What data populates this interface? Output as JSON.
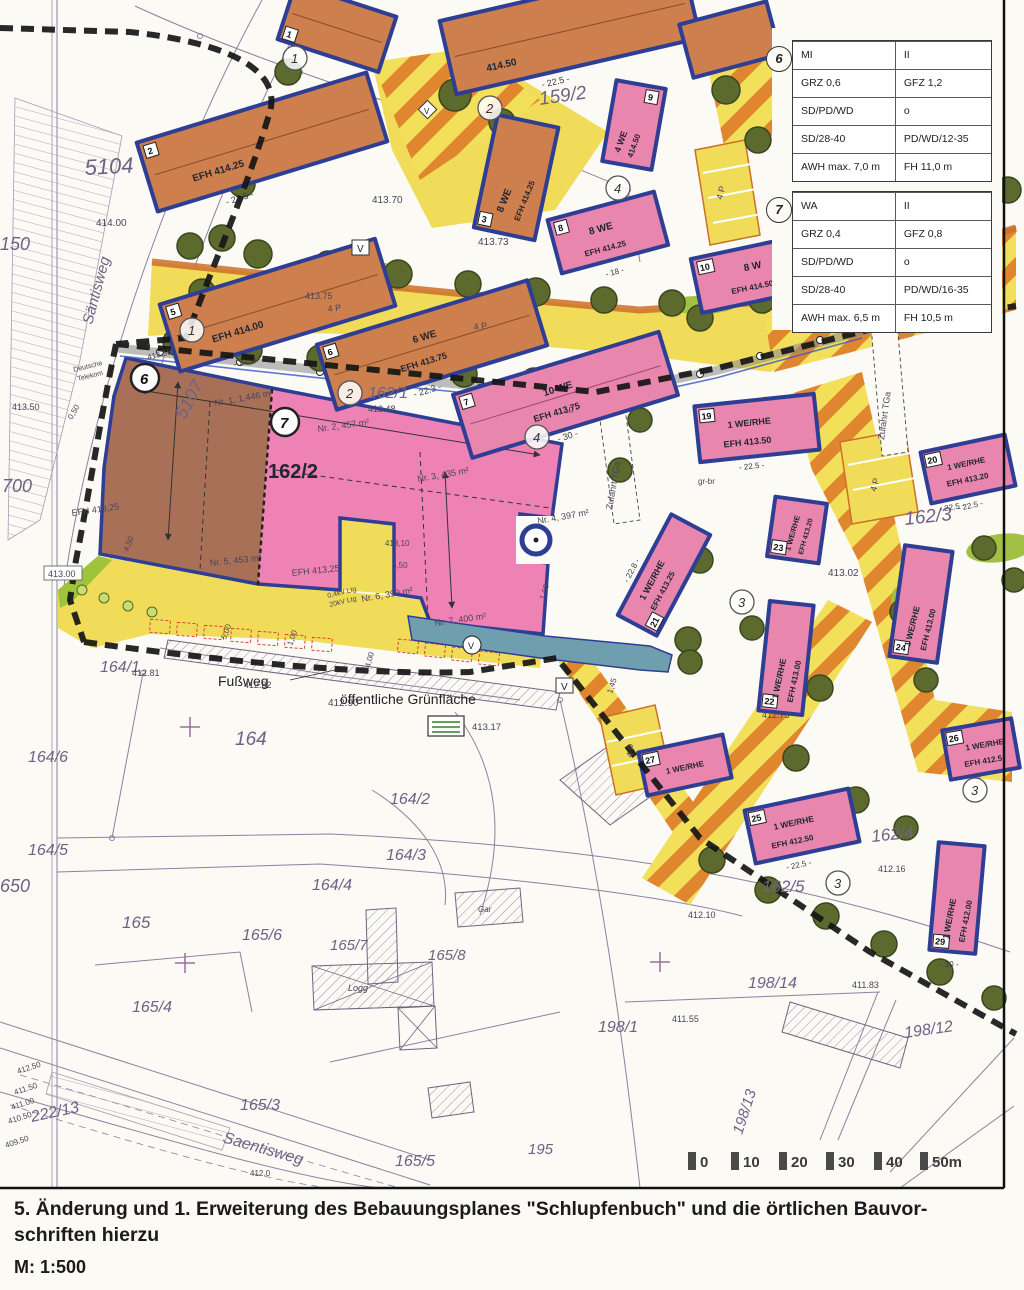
{
  "page": {
    "caption_line1": "5. Änderung und 1. Erweiterung des Bebauungsplanes \"Schlupfenbuch\" und die örtlichen Bauvor-",
    "caption_line2": "schriften hierzu",
    "scale_label": "M: 1:500"
  },
  "legend": {
    "zones": [
      {
        "marker": "6",
        "rows": [
          [
            "MI",
            "II"
          ],
          [
            "GRZ 0,6",
            "GFZ 1,2"
          ],
          [
            "SD/PD/WD",
            "o"
          ],
          [
            "SD/28-40",
            "PD/WD/12-35"
          ],
          [
            "AWH max. 7,0 m",
            "FH 11,0 m"
          ]
        ]
      },
      {
        "marker": "7",
        "rows": [
          [
            "WA",
            "II"
          ],
          [
            "GRZ 0,4",
            "GFZ 0,8"
          ],
          [
            "SD/PD/WD",
            "o"
          ],
          [
            "SD/28-40",
            "PD/WD/16-35"
          ],
          [
            "AWH max. 6,5 m",
            "FH 10,5 m"
          ]
        ]
      }
    ]
  },
  "scalebar": {
    "ticks": [
      "0",
      "10",
      "20",
      "30",
      "40",
      "50m"
    ]
  },
  "colors": {
    "street_yellow": "#f0dc58",
    "street_stripe": "#e0862e",
    "zone_brown": "#a87157",
    "zone_pink": "#ee82b4",
    "building_border": "#2e3e94",
    "building_orange": "#cd7f4e",
    "building_pink": "#e886ae",
    "tree_green": "#5c6a2e",
    "green_area": "#6f9fae",
    "boundary_black": "#161616"
  },
  "labels": {
    "p5104": "5104",
    "p5107": "5107",
    "p700": "700",
    "p650": "650",
    "p150": "150",
    "p159_2": "159/2",
    "p162_1": "162/1",
    "p162_2": "162/2",
    "p162_3": "162/3",
    "p162_4": "162/4",
    "p162_5": "162/5",
    "p164": "164",
    "p164_1": "164/1",
    "p164_2": "164/2",
    "p164_3": "164/3",
    "p164_4": "164/4",
    "p164_5": "164/5",
    "p164_6": "164/6",
    "p165": "165",
    "p165_3": "165/3",
    "p165_4": "165/4",
    "p165_5": "165/5",
    "p165_6": "165/6",
    "p165_7": "165/7",
    "p165_8": "165/8",
    "p195": "195",
    "p198_1": "198/1",
    "p198_12": "198/12",
    "p198_13": "198/13",
    "p198_14": "198/14",
    "p222_13": "222/13",
    "saentisweg1": "Säntisweg",
    "saentisweg2": "Saentisweg",
    "fussweg": "Fußweg",
    "gruenflaeche": "öffentliche Grünfläche",
    "zufahrt_tga": "Zufahrt TGa",
    "e41400": "414.00",
    "e41350": "413.50",
    "e41355": "413.55",
    "e41370": "413.70",
    "e41373": "413.73",
    "e41375": "413.75",
    "e41348": "413.48",
    "e41317": "413.17",
    "e41302": "413.02",
    "e41300": "413.00",
    "e41290": "412.90",
    "e41282": "412.82",
    "e41281": "412.81",
    "e41273": "412.73",
    "e41250": "412.50",
    "e41216": "412.16",
    "e41210": "412.10",
    "e4120": "412.0",
    "e41183": "411.83",
    "e41155": "411.55",
    "e41150": "411.50",
    "e41100": "411.00",
    "e41050": "410.50",
    "e40950": "409.50",
    "efh41325": "EFH 413,25",
    "efh41425": "EFH 414.25",
    "efh41400": "EFH 414.00",
    "efh41375": "EFH 413.75",
    "efh41450": "EFH 414.50",
    "efh41350": "EFH 413.50",
    "efh41320": "EFH 413.20",
    "efh41325b": "EFH 413.25",
    "efh41300": "EFH 413.00",
    "efh41250": "EFH 412.50",
    "efh4125": "EFH 412.5",
    "efh41200": "EFH 412.00",
    "we6": "6 WE",
    "we10": "10 WE",
    "we8": "8 WE",
    "we4": "4 WE",
    "we8b": "8 W",
    "e41450": "414.50",
    "werhe": "1 WE/RHE",
    "lot1": "Nr. 1, 1.446 m²",
    "lot2": "Nr. 2, 457 m²",
    "lot3": "Nr. 3, 435 m²",
    "lot4": "Nr. 4, 397 m²",
    "lot5": "Nr. 5, 453 m²",
    "lot6": "Nr. 6, 399 m²",
    "lot7": "Nr. 7, 400 m²",
    "d41310": "413,10",
    "d550": "5,50",
    "d100": "1,00",
    "d450": "4,50",
    "d400": "4,00",
    "d145": "1,45",
    "d500": "5,00",
    "d050": "0,50",
    "kv04": "0,4kV Ltg",
    "kv20": "20kV Ltg",
    "grbr": "gr-br",
    "deutsche": "Deutsche",
    "telekom": "Telekom",
    "logg": "Logg",
    "gar": "Gar",
    "vsym": "V",
    "p4": "4 P",
    "dim225": "- 22.5 -",
    "dim223": "- 22.3 -",
    "dim228": "- 22.8 -",
    "dim18": "- 18 -",
    "dim30": "- 30 -",
    "dim10": "- 10 -",
    "n1": "1",
    "n2": "2",
    "n3": "3",
    "n4": "4",
    "n5": "5",
    "n6": "6",
    "n7": "7",
    "n8": "8",
    "n9": "9",
    "n10": "10",
    "n19": "19",
    "n20": "20",
    "n21": "21",
    "n22": "22",
    "n23": "23",
    "n24": "24",
    "n25": "25",
    "n26": "26",
    "n27": "27",
    "n29": "29"
  }
}
